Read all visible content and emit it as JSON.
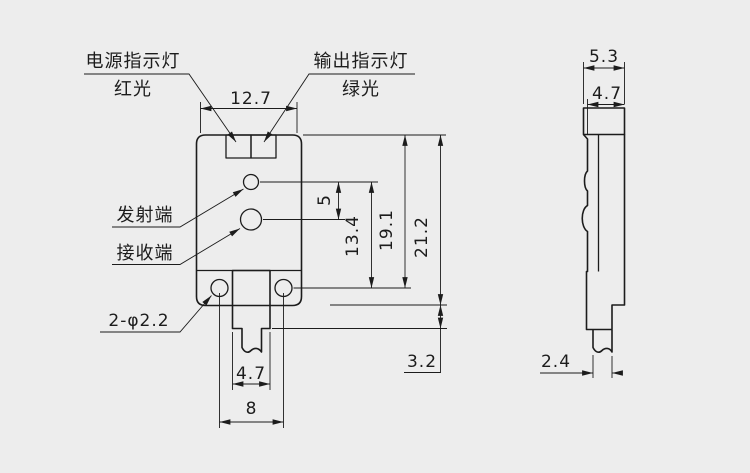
{
  "canvas": {
    "background": "#ededed",
    "line_color": "#1c1c1c"
  },
  "front_view": {
    "labels": {
      "power_indicator": {
        "line1": "电源指示灯",
        "line2": "红光"
      },
      "output_indicator": {
        "line1": "输出指示灯",
        "line2": "绿光"
      },
      "emitter": "发射端",
      "receiver": "接收端",
      "mounting_holes": "2-φ2.2"
    },
    "dimensions": {
      "top_width": "12.7",
      "lens_spacing": "5",
      "emitter_to_hole": "13.4",
      "top_to_hole_center": "19.1",
      "body_height": "21.2",
      "tab_below_body": "3.2",
      "tab_width": "4.7",
      "hole_spacing": "8"
    }
  },
  "side_view": {
    "dimensions": {
      "overall_depth": "5.3",
      "body_depth": "4.7",
      "cable_width": "2.4"
    }
  }
}
